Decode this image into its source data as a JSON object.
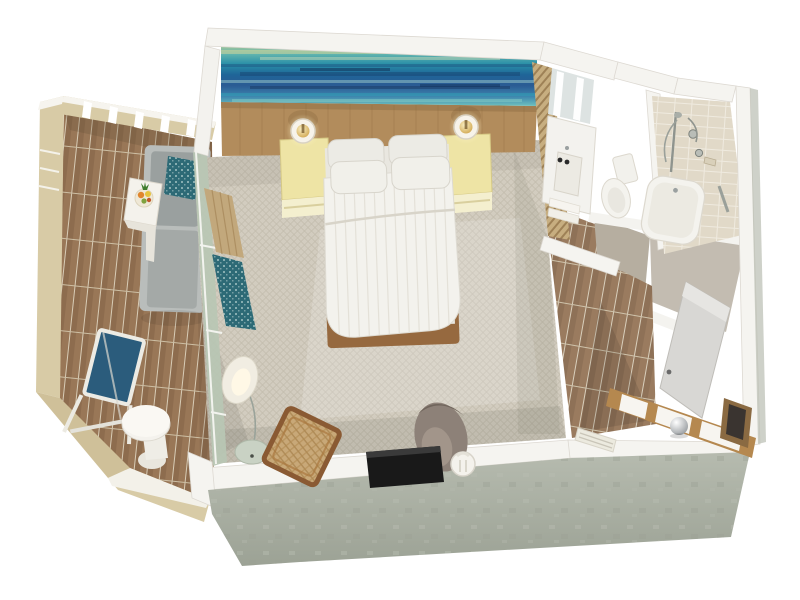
{
  "scene": {
    "title": "3D floor plan rendering of a hotel guest suite",
    "type": "isometric-3d-floor-plan",
    "labels": {
      "floor_plan": "Hotel suite 3D floor plan",
      "bedroom": "Bedroom",
      "balcony": "Balcony",
      "bathroom": "Bathroom vanity and toilet area",
      "shower_room": "Shower and bathtub room",
      "entry_hall": "Entry hallway",
      "closet": "Closet shelving",
      "king_bed": "King bed with white duvet and four pillows",
      "headboard_wall": "Wood headboard wall",
      "ocean_artwork": "Abstract ocean artwork panel",
      "nightstand_left": "Left nightstand with table lamp",
      "nightstand_right": "Right nightstand with table lamp",
      "curtains": "Window curtains",
      "window_wall": "Floor-to-ceiling balcony window",
      "arc_floor_lamp": "Arc floor lamp",
      "wicker_armchair": "Wicker armchair",
      "tub_chair": "Upholstered tub chair",
      "tv": "Wall-mounted flat-screen TV",
      "tv_lamp": "White table lamp beside TV",
      "chaise": "Outdoor chaise lounge with teal pillow",
      "side_table": "Outdoor side table with fruit bowl",
      "folding_chair": "Blue folding sling chair",
      "round_table": "Round pedestal table",
      "vanity": "Bathroom vanity with sink and lit mirror",
      "towels": "Folded towels",
      "toilet": "Toilet",
      "bathtub": "Bathtub with tiled shower wall and fixtures",
      "entry_door": "Open entry door",
      "luggage_sphere": "Decorative silver sphere",
      "vent": "Wall vent grille",
      "railing": "Balcony railing",
      "slat_screen": "Louvered wood screen",
      "exterior_wall": "Concrete exterior wall"
    },
    "palette": {
      "background": "#ffffff",
      "wall_top": "#f5f4f0",
      "concrete": "#a9aea2",
      "railing_cream": "#d8cba6",
      "balcony_wood": "#997757",
      "hall_wood": "#9a7b5f",
      "carpet": "#d2ccbf",
      "headboard_wood": "#b28c5c",
      "art_blue": "#1f6598",
      "art_teal": "#2a8fa8",
      "nightstand_yellow": "#eee4a5",
      "lamp_gold": "#cda045",
      "bedding_white": "#f3f2ed",
      "bed_frame_brown": "#96693f",
      "chaise_gray": "#9da3a2",
      "accent_teal": "#2d6a76",
      "chair_blue": "#2b5c7c",
      "tile": "#e9e1d1",
      "fixture_white": "#f4f3ee",
      "door_gray": "#d8d7d4",
      "tub_chair_taupe": "#8d8178",
      "tv_black": "#191919"
    }
  }
}
